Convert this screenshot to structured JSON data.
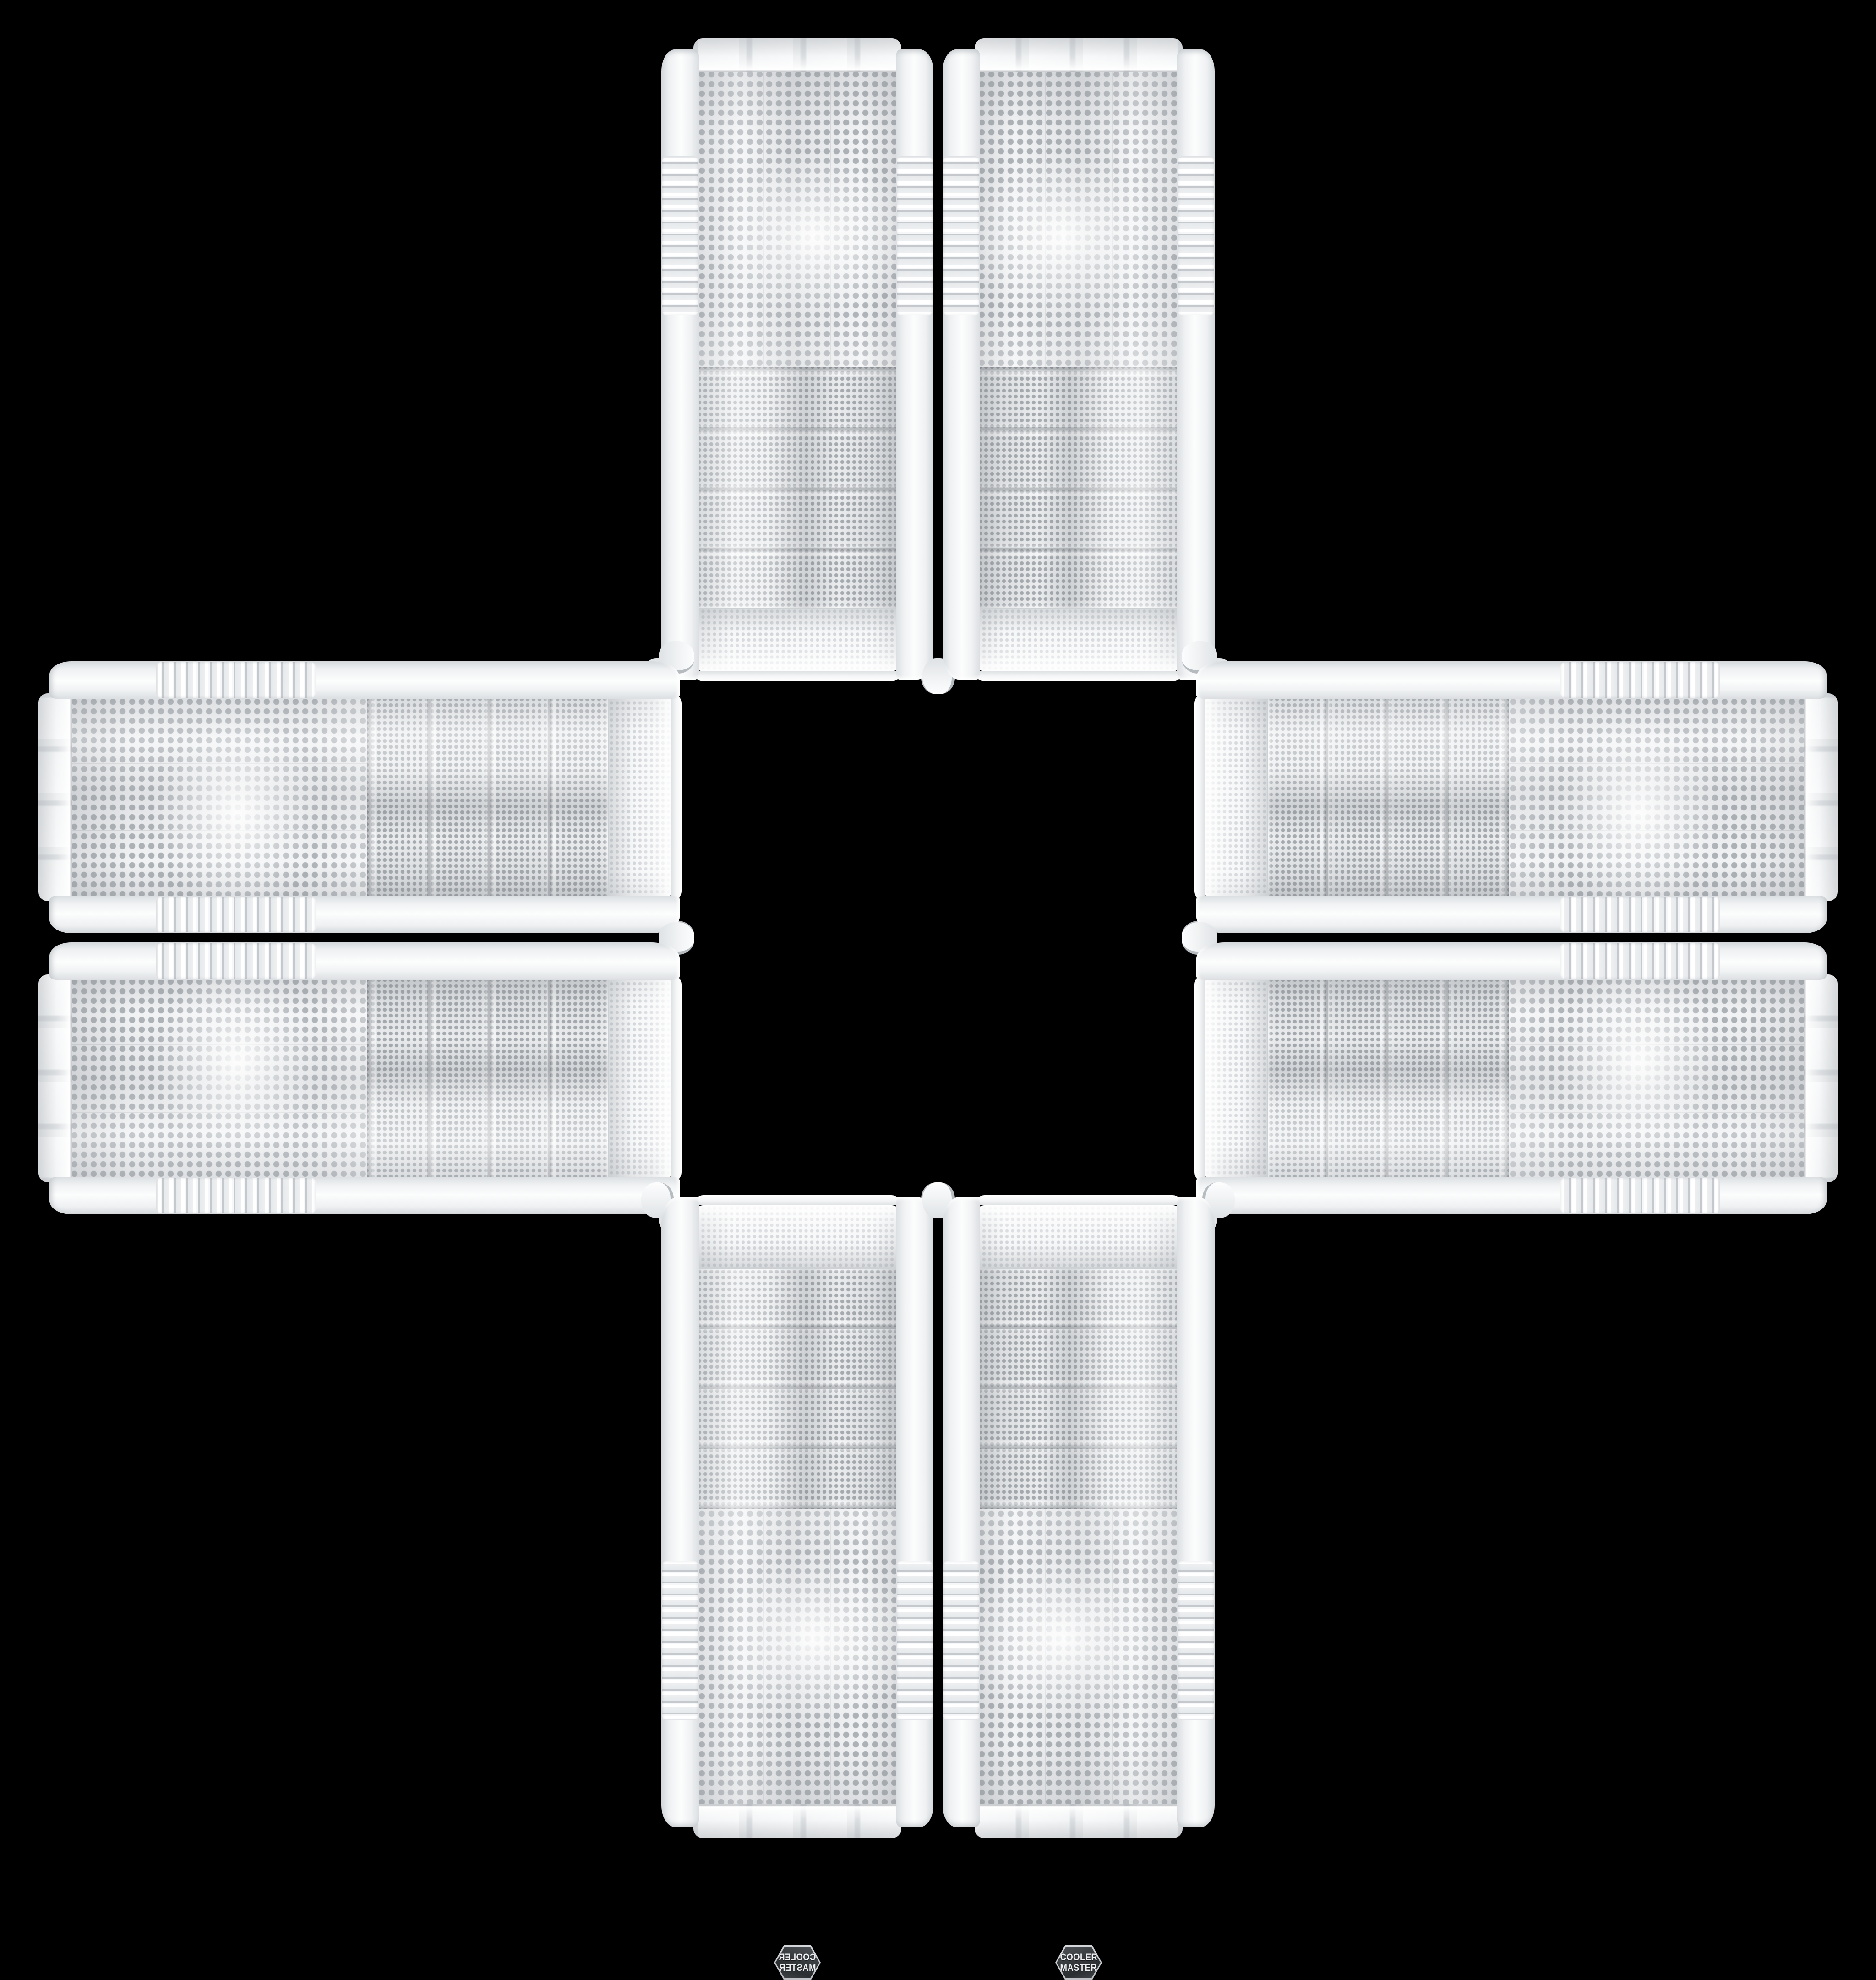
{
  "page": {
    "background_color": "#000000",
    "description": "Eight identical white Cooler Master PC tower cases with perforated mesh front panels arranged in a symmetrical cross / plus pattern on a black background, mirrored across both axes",
    "arrangement": "cross-of-eight",
    "canvas_size": "4096x4096"
  },
  "brand": {
    "line1": "COOLER",
    "line2": "MASTER",
    "badge_shape": "hexagon",
    "badge_background": "#34373a",
    "badge_text_color": "#eef0f1"
  },
  "product": {
    "type": "PC tower case front panel",
    "body_color": "#f2f4f5",
    "trim_color": "#c5c9cd",
    "chrome_color": "#aeb4ba",
    "mesh_dot_color": "#aab0b5",
    "drive_bay_rows": 4,
    "features": [
      "top mesh bulge",
      "drive bay mesh rows",
      "large fan mesh with badge",
      "tabbed bottom bezel",
      "side rails with ribbed fins",
      "chrome trim strips",
      "corner foot knobs"
    ]
  },
  "instances": [
    {
      "name": "pc-case-top-left",
      "position": "top-left",
      "orientation": "rotated-180"
    },
    {
      "name": "pc-case-top-right",
      "position": "top-right",
      "orientation": "flipped-vertical"
    },
    {
      "name": "pc-case-left-top",
      "position": "left-top",
      "orientation": "rotated-90-ccw-mirrored"
    },
    {
      "name": "pc-case-right-top",
      "position": "right-top",
      "orientation": "rotated-90-ccw"
    },
    {
      "name": "pc-case-left-bottom",
      "position": "left-bottom",
      "orientation": "rotated-90-cw"
    },
    {
      "name": "pc-case-right-bottom",
      "position": "right-bottom",
      "orientation": "rotated-90-ccw-flipped-vertical"
    },
    {
      "name": "pc-case-bottom-left",
      "position": "bottom-left",
      "orientation": "mirrored-horizontal"
    },
    {
      "name": "pc-case-bottom-right",
      "position": "bottom-right",
      "orientation": "upright"
    }
  ]
}
